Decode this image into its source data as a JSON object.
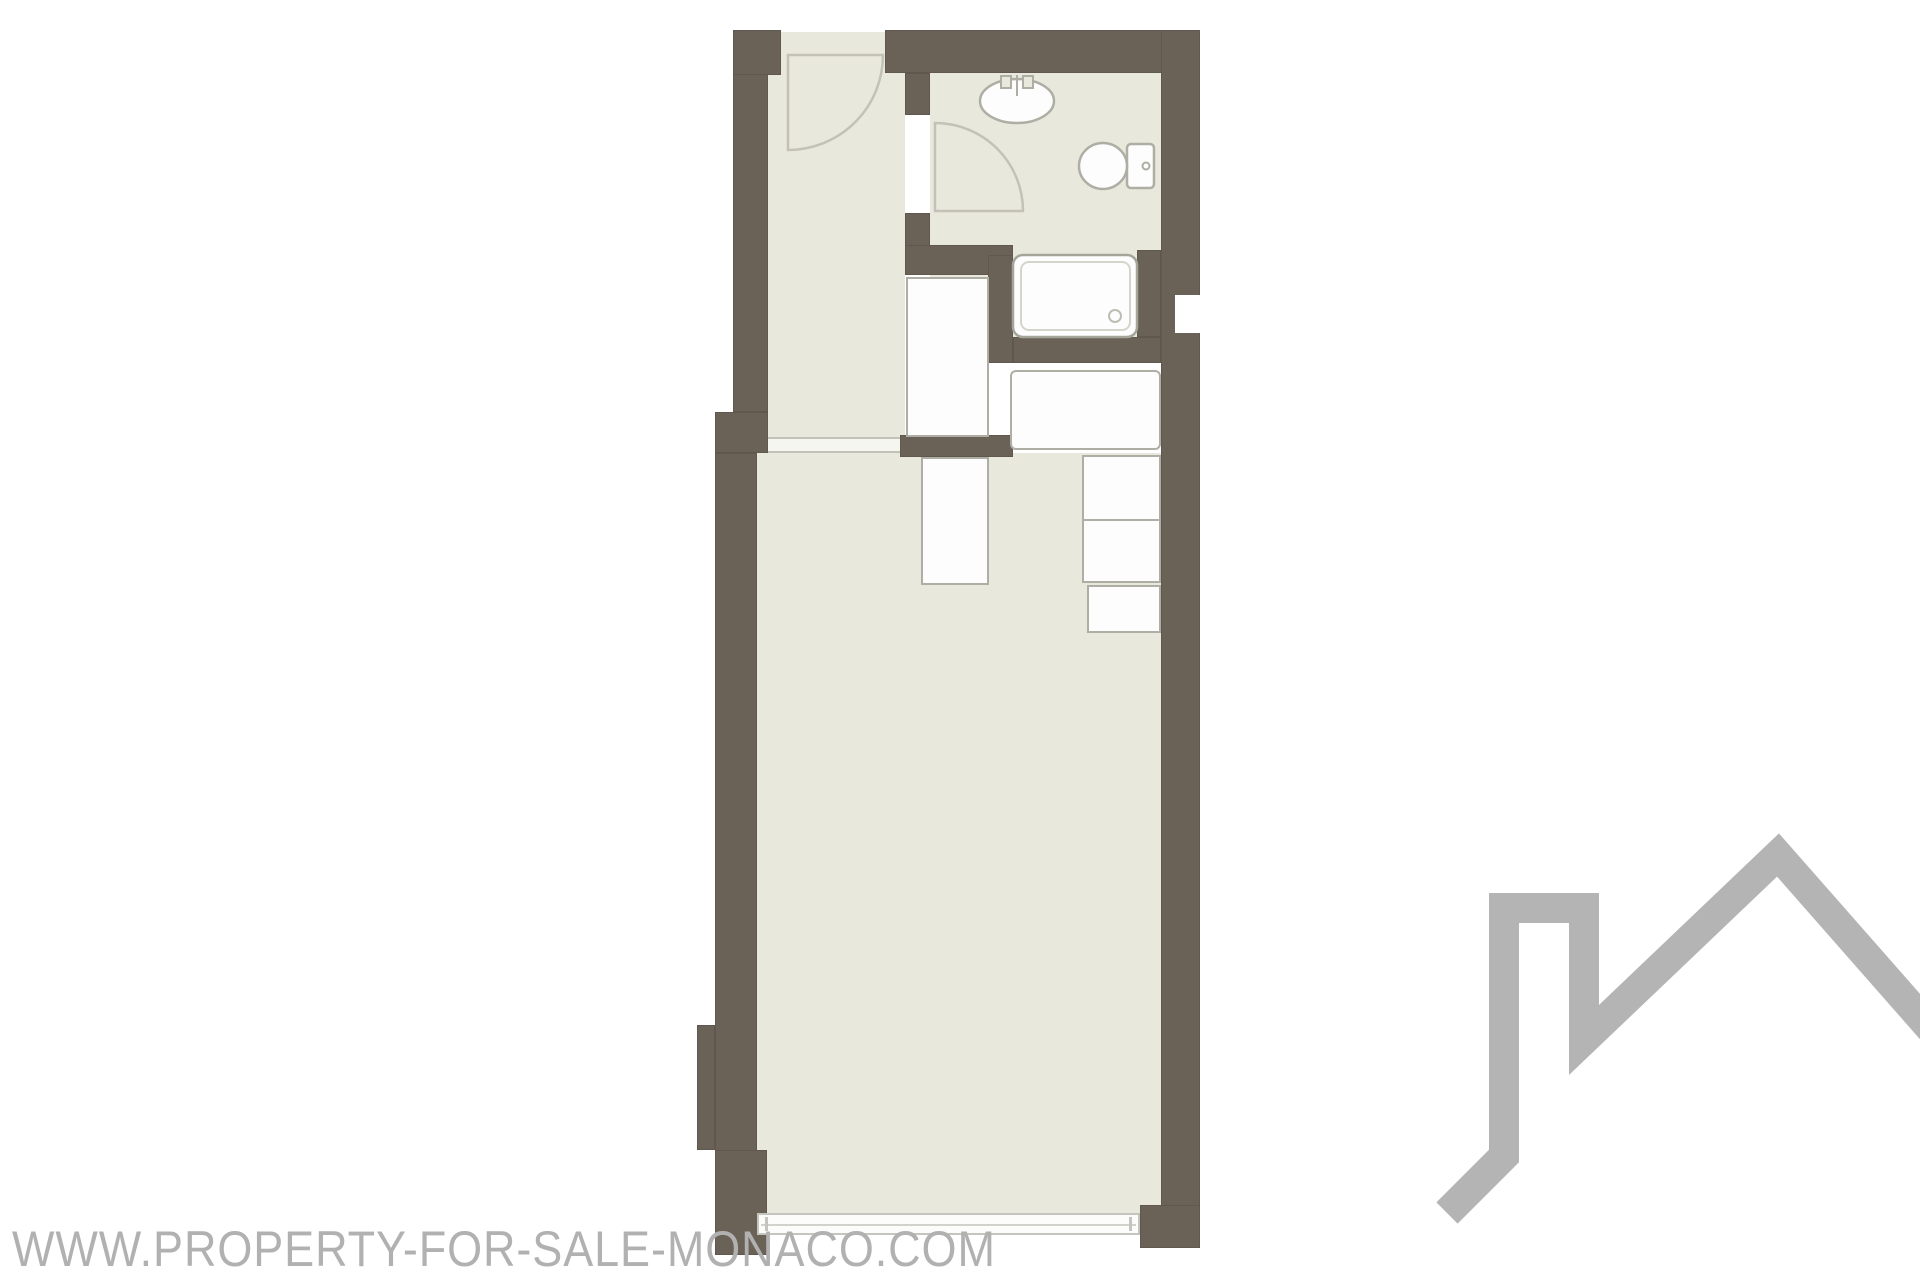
{
  "watermark": {
    "text": "WWW.PROPERTY-FOR-SALE-MONACO.COM"
  },
  "logo": {
    "icon": "house-roofline-with-chimney-icon"
  },
  "colors": {
    "wall": "#6b6257",
    "floor": "#e9e8dc",
    "fixture_fill": "#fdfdfd",
    "fixture_stroke": "#aeaea4",
    "line": "#c3c2b8",
    "watermark": "#b2b1b1",
    "logo": "#b5b4b4",
    "background": "#ffffff"
  },
  "floorplan": {
    "type": "studio-apartment-floor-plan",
    "rooms": [
      {
        "name": "entrance-hall"
      },
      {
        "name": "bathroom"
      },
      {
        "name": "main-room"
      }
    ],
    "fixtures": [
      "entry-door-swing",
      "bathroom-door-swing",
      "washbasin",
      "toilet",
      "bathtub",
      "hall-closet",
      "wardrobe",
      "kitchen-unit-upper",
      "kitchen-unit-lower",
      "storage-unit",
      "window-bay"
    ]
  }
}
